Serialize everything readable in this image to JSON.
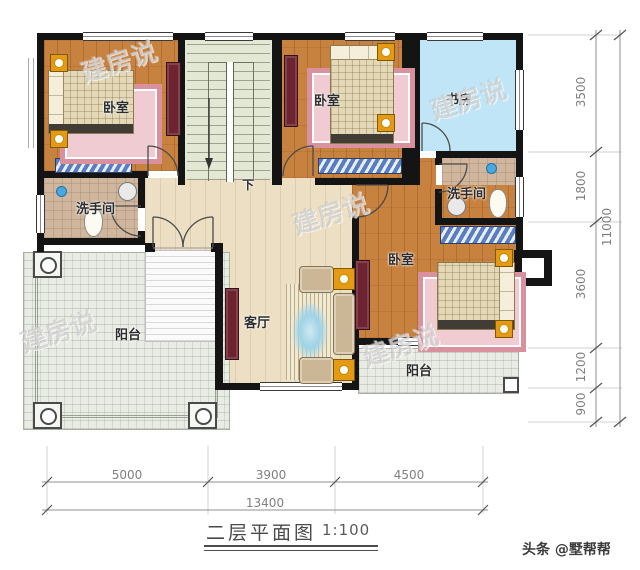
{
  "meta": {
    "title": "二层平面图",
    "scale": "1:100",
    "credit": "头条 @墅帮帮",
    "watermark": "建房说"
  },
  "rooms": {
    "bedroom1": "卧室",
    "bedroom2": "卧室",
    "bedroom3": "卧室",
    "study": "书房",
    "bath_left": "洗手间",
    "bath_right": "洗手间",
    "living": "客厅",
    "balcony_left": "阳台",
    "balcony_right": "阳台",
    "stair_down": "下"
  },
  "dims": {
    "right": [
      "3500",
      "1800",
      "3600",
      "1200",
      "900"
    ],
    "right_total": "11000",
    "bottom": [
      "5000",
      "3900",
      "4500"
    ],
    "bottom_total": "13400"
  },
  "colors": {
    "wall": "#141414",
    "wood_floor": "#c8823f",
    "study_floor": "#bfe5f6",
    "bath_floor": "#cfb69d",
    "hall_floor": "#ecdfc4",
    "stair_floor": "#e3e8d5",
    "balcony_floor": "#e9ece4",
    "rug_pink": "#d8919d",
    "cabinet_red": "#6e2330",
    "closet_blue": "#5a7cc0",
    "lamp_orange": "#e49a14"
  }
}
